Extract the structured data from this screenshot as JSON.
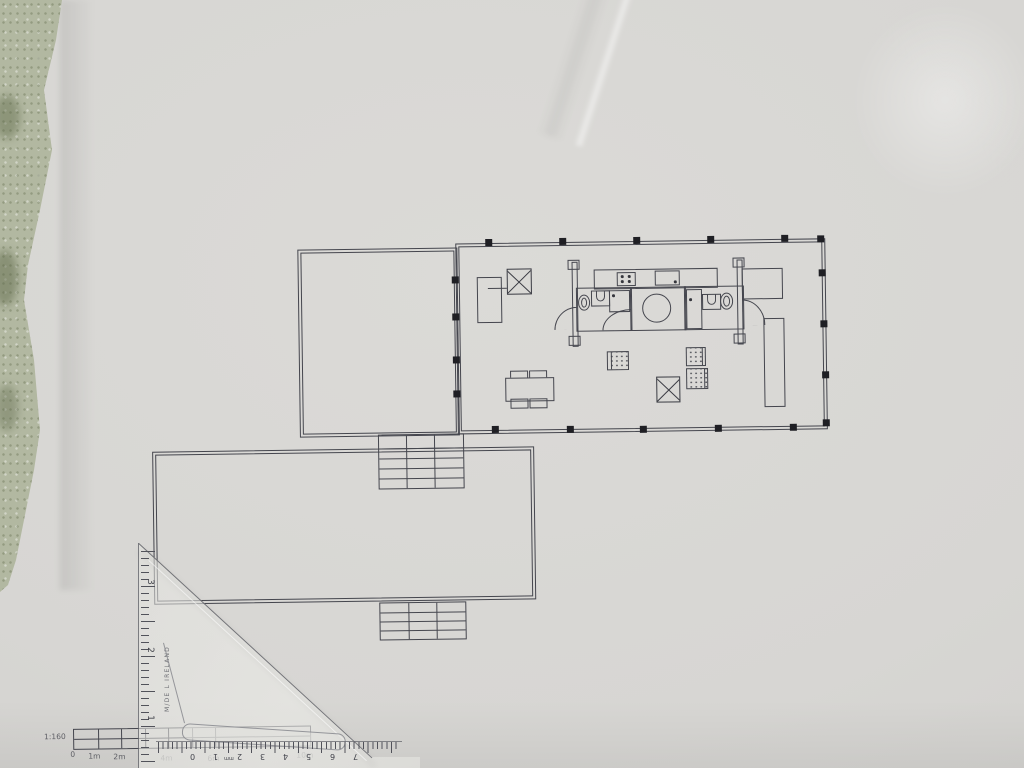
{
  "colors": {
    "ink": "#45464e",
    "paper": "#d7d6d3",
    "column_marker": "#1f1f24",
    "table_surface": "#b2b8a1",
    "plastic_edge": "#7a7b82"
  },
  "scale_note": {
    "ratio_label": "1:160",
    "tick_labels": [
      "0",
      "1m",
      "2m",
      "4m",
      "6m",
      "10m"
    ]
  },
  "set_square": {
    "brand_text": "M/DE L IRELAND",
    "vertical_scale_numbers": [
      "3",
      "2",
      "1"
    ],
    "base_scale_numbers": [
      "0",
      "1",
      "2",
      "3",
      "4",
      "5",
      "6",
      "7"
    ],
    "base_unit_label": "mm"
  },
  "plan": {
    "fixtures": [
      "wardrobe",
      "stove",
      "kitchen-counter",
      "kitchen-sink",
      "toilet",
      "washbasin",
      "shower",
      "round-shower",
      "dining-table",
      "chair",
      "stool",
      "bench",
      "stairs",
      "column",
      "door-swing"
    ]
  }
}
